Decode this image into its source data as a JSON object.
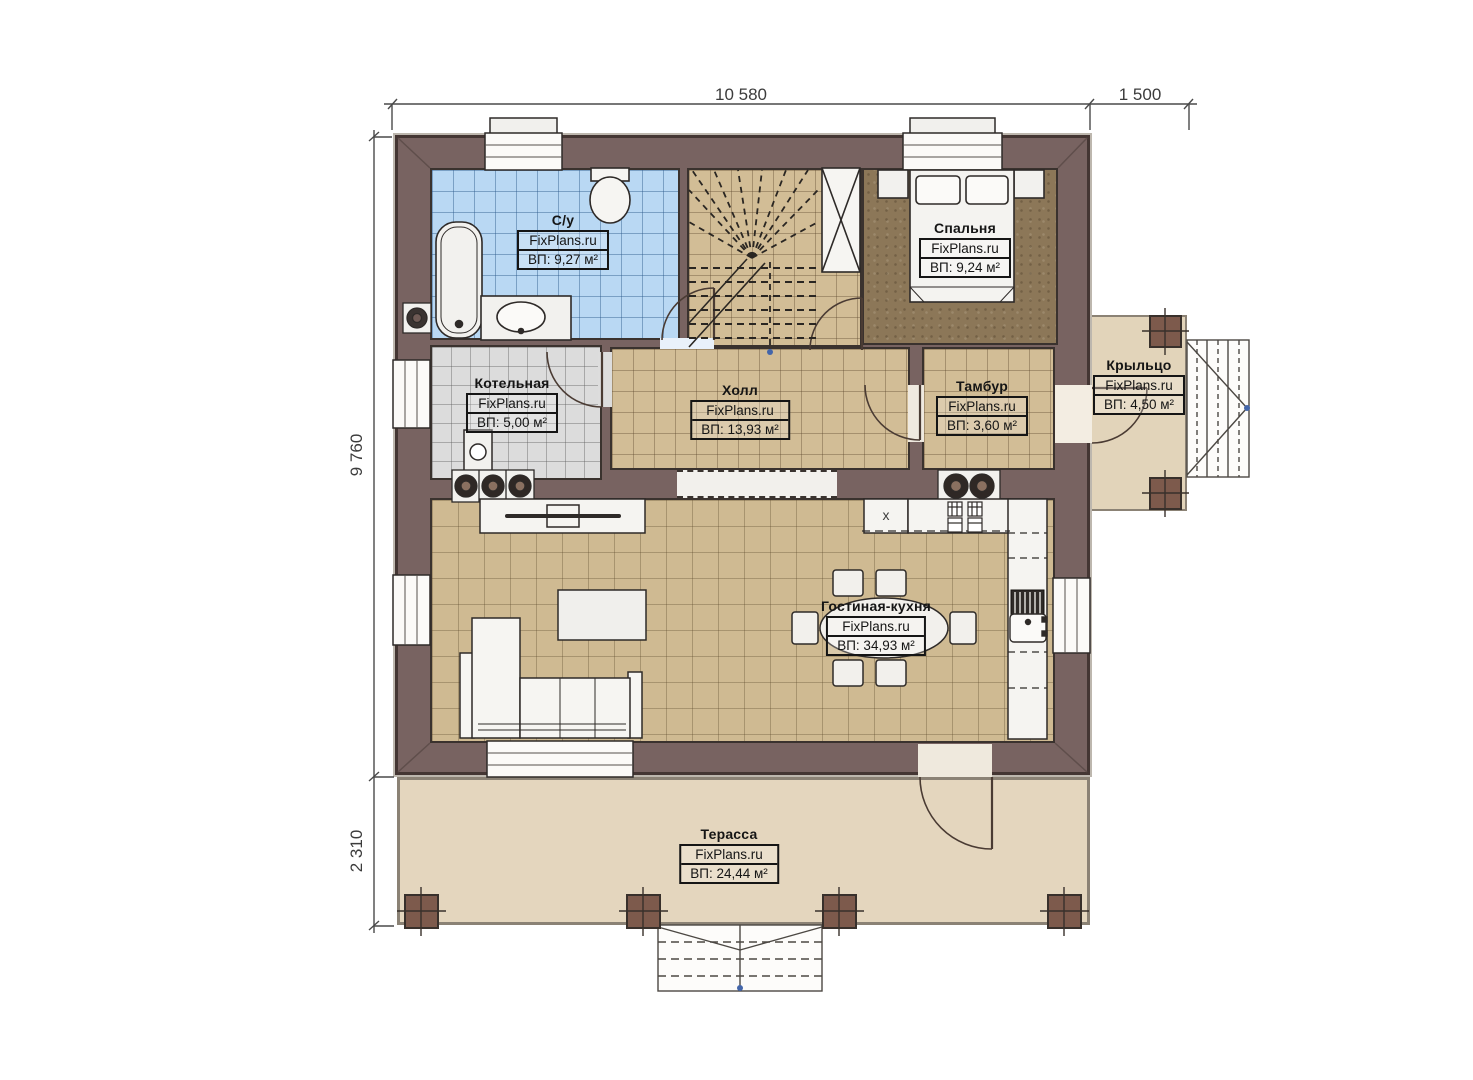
{
  "site_brand": "FixPlans.ru",
  "dimensions": {
    "top_width": "10 580",
    "top_right_porch": "1 500",
    "left_height": "9 760",
    "left_terrace": "2 310"
  },
  "rooms": {
    "bathroom": {
      "name": "С/у",
      "brand": "FixPlans.ru",
      "area": "ВП: 9,27 м²"
    },
    "bedroom": {
      "name": "Спальня",
      "brand": "FixPlans.ru",
      "area": "ВП: 9,24 м²"
    },
    "boiler": {
      "name": "Котельная",
      "brand": "FixPlans.ru",
      "area": "ВП: 5,00 м²"
    },
    "hall": {
      "name": "Холл",
      "brand": "FixPlans.ru",
      "area": "ВП: 13,93 м²"
    },
    "vestibule": {
      "name": "Тамбур",
      "brand": "FixPlans.ru",
      "area": "ВП: 3,60 м²"
    },
    "porch": {
      "name": "Крыльцо",
      "brand": "FixPlans.ru",
      "area": "ВП: 4,50 м²"
    },
    "living_kitchen": {
      "name": "Гостиная-кухня",
      "brand": "FixPlans.ru",
      "area": "ВП: 34,93 м²"
    },
    "terrace": {
      "name": "Терасса",
      "brand": "FixPlans.ru",
      "area": "ВП: 24,44 м²"
    }
  },
  "kitchen": {
    "fridge_label": "x"
  },
  "colors": {
    "wall": "#786361",
    "tile_tan": "#d2bd96",
    "tile_blue": "#b9d8f3",
    "tile_gray": "#dcdcdc",
    "bedroom_floor": "#8c7758",
    "terrace": "#e4d6be",
    "post": "#7d5a4c",
    "line_dark": "#2e2a28"
  }
}
